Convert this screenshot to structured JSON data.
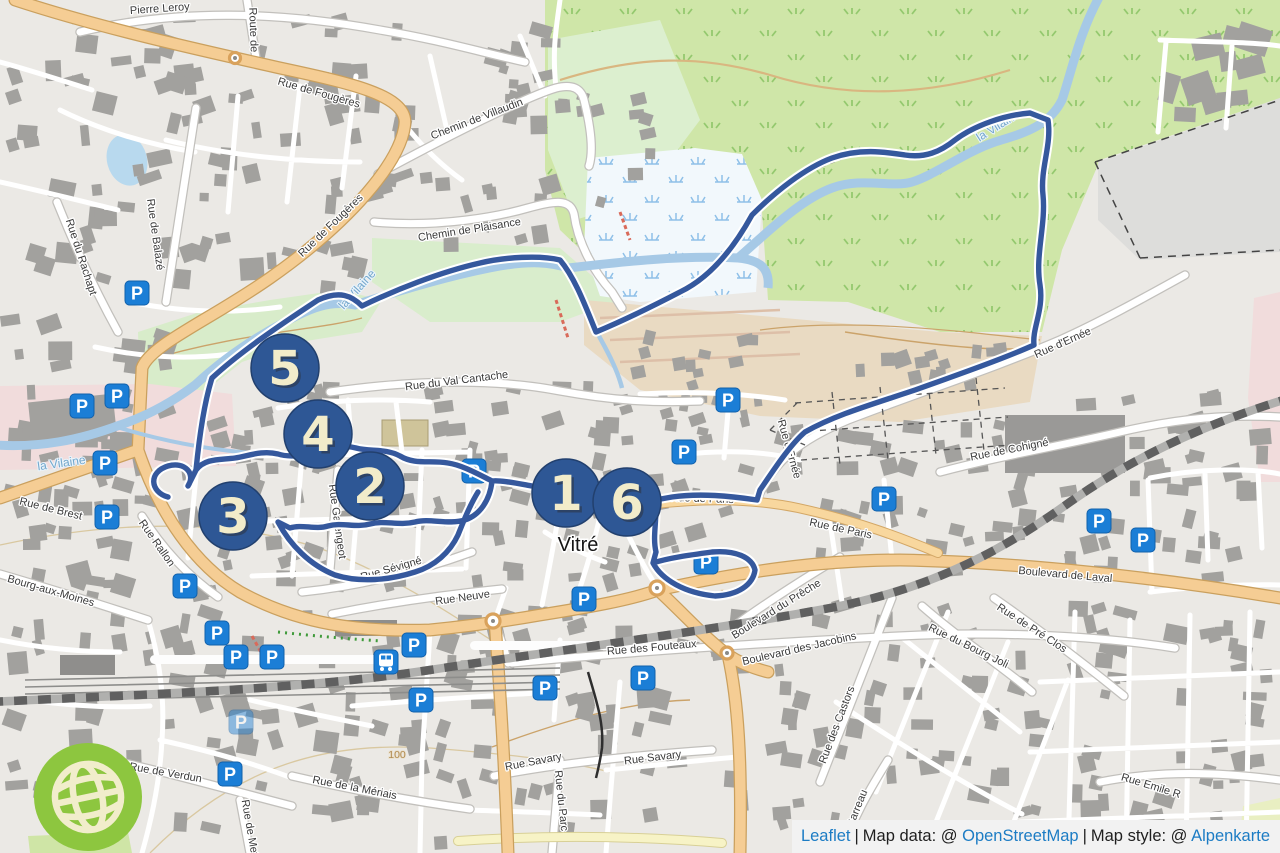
{
  "attribution": {
    "leaflet": "Leaflet",
    "sep1": "|",
    "map_data_prefix": "Map data: @",
    "osm": "OpenStreetMap",
    "sep2": "|",
    "map_style_prefix": "Map style: @",
    "style_name": "Alpenkarte"
  },
  "city_label": "Vitré",
  "contour_label": "100",
  "parking_letter": "P",
  "markers": [
    "1",
    "2",
    "3",
    "4",
    "5",
    "6"
  ],
  "streets": {
    "pierre_leroy": "Pierre Leroy",
    "rue_de_fougeres": "Rue de Fougères",
    "route_de": "Route de",
    "chemin_de_villaudin": "Chemin de Villaudin",
    "chemin_de_plaisance": "Chemin de Plaisance",
    "rue_de_balaze": "Rue de Balazé",
    "rue_du_rachapt": "Rue du Rachapt",
    "rue_du_val_cantache": "Rue du Val Cantache",
    "rue_de_brest": "Rue de Brest",
    "rue_rallon": "Rue Rallon",
    "bourg_aux_moines": "Bourg-aux-Moines",
    "rue_garengeot": "Rue Garengeot",
    "rue_sevigne": "Rue Sévigné",
    "rue_neuve": "Rue Neuve",
    "rue_de_paris": "Rue de Paris",
    "rue_de_cohigne": "Rue de Cohigné",
    "rue_d_ernee": "Rue d'Ernée",
    "boulevard_de_laval": "Boulevard de Laval",
    "boulevard_du_preche": "Boulevard du Prêche",
    "boulevard_des_jacobins": "Boulevard des Jacobins",
    "rue_des_fouteaux": "Rue des Fouteaux",
    "rue_savary": "Rue Savary",
    "rue_du_parc": "Rue du Parc",
    "rue_de_la_meriais": "Rue de la Mériais",
    "rue_de_verdun": "Rue de Verdun",
    "rue_de_metz": "Rue de Metz",
    "rue_des_castors": "Rue des Castors",
    "rue_du_bourg_joli": "Rue du Bourg Joli",
    "rue_de_pre_clos": "Rue de Pré Clos",
    "rue_emile": "Rue Emile R",
    "rue_garreau": "Garreau"
  },
  "rivers": {
    "la_vilaine": "la Vilaine"
  },
  "colors": {
    "marker_fill": "#2e5795",
    "marker_number": "#f2ecca",
    "route_blue": "#35589d",
    "parking_blue": "#1b7ed6",
    "logo_green": "#8dc63f",
    "link_blue": "#1c7cc4",
    "attribution_bg": "#f2f2f2",
    "water": "#a6c9e6",
    "main_road": "#f5cd94"
  }
}
